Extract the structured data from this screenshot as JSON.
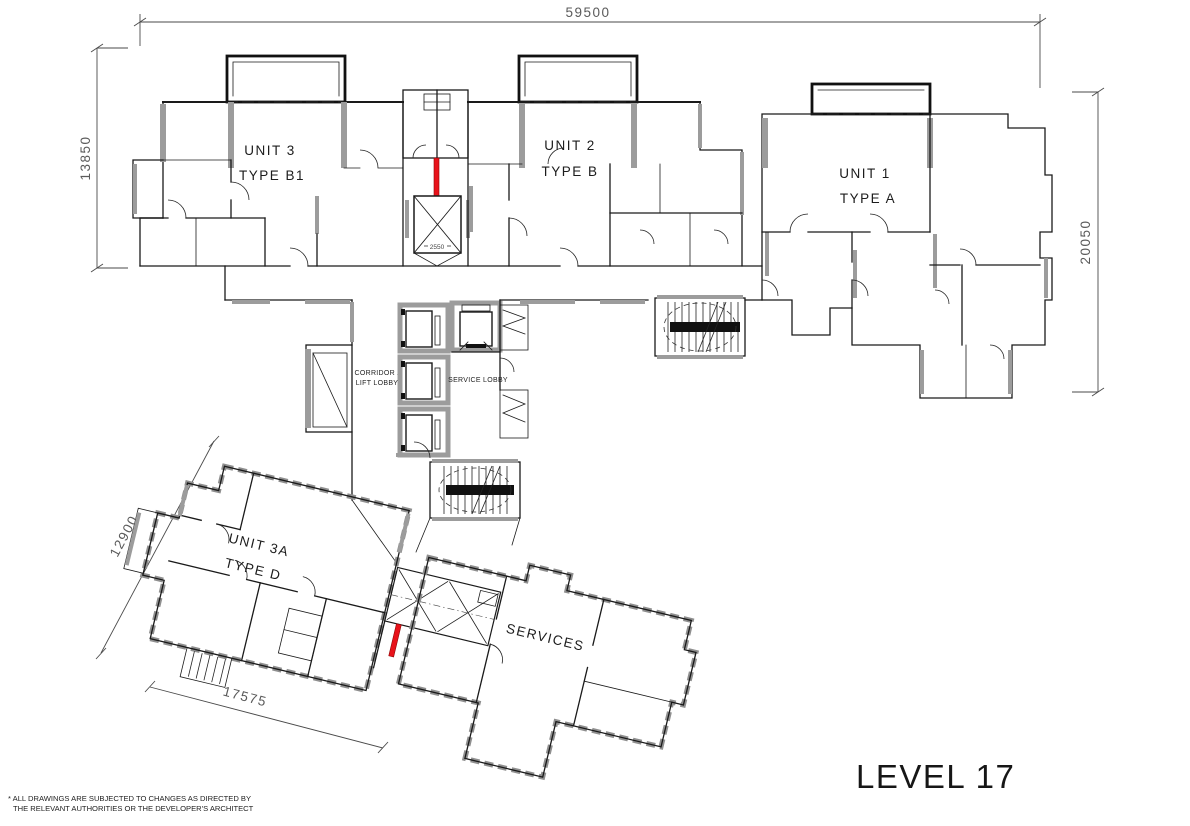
{
  "drawing": {
    "level_title": "LEVEL 17",
    "footnote_line1": "* ALL DRAWINGS ARE SUBJECTED TO CHANGES AS DIRECTED BY",
    "footnote_line2": "THE RELEVANT AUTHORITIES OR THE DEVELOPER'S ARCHITECT"
  },
  "dimensions": {
    "overall_width": "59500",
    "left_wing_height": "13850",
    "right_wing_height": "20050",
    "lower_wing_height": "12900",
    "lower_wing_width": "17575",
    "lift_well": "2550"
  },
  "units": [
    {
      "name": "UNIT 3",
      "type": "TYPE B1"
    },
    {
      "name": "UNIT 2",
      "type": "TYPE B"
    },
    {
      "name": "UNIT 1",
      "type": "TYPE A"
    },
    {
      "name": "UNIT 3A",
      "type": "TYPE D"
    }
  ],
  "areas": {
    "corridor_line1": "CORRIDOR /",
    "corridor_line2": "LIFT LOBBY",
    "service_lobby": "SERVICE LOBBY",
    "services": "SERVICES"
  },
  "colors": {
    "wall": "#1a1a1a",
    "shear_wall": "#9c9c9c",
    "highlight_red": "#e8121a",
    "dimension": "#5a5a5a",
    "background": "#ffffff"
  }
}
